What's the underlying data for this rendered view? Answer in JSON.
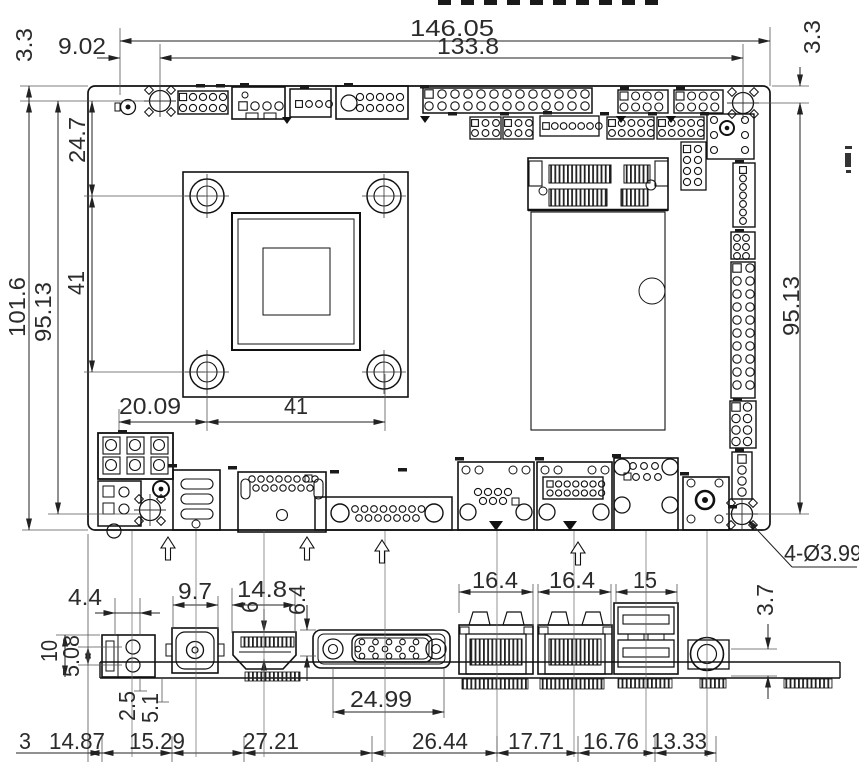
{
  "top_view": {
    "width_overall": "146.05",
    "width_holes": "133.8",
    "hole_offset_x": "9.02",
    "edge_top_left": "3.3",
    "edge_top_right": "3.3",
    "height_overall": "101.6",
    "height_holes_left": "95.13",
    "height_holes_right": "95.13",
    "cpu_hole_top": "24.7",
    "cpu_pitch_v": "41",
    "cpu_offset_x": "20.09",
    "cpu_pitch_h": "41",
    "mount_hole_note": "4-Ø3.99"
  },
  "rear_view": {
    "power_width": "4.4",
    "power_height": "10",
    "power_pin_pitch": "5.08",
    "dc_width": "9.7",
    "hdmi_width": "14.8",
    "hdmi_height": "6",
    "vga_height": "6.4",
    "vga_screw_span": "24.99",
    "lan1_width": "16.4",
    "lan2_width": "16.4",
    "usb_width": "15",
    "audio_height": "3.7",
    "pad_offset_1": "2.5",
    "pad_offset_2": "5.1",
    "chain": [
      "3",
      "14.87",
      "15.29",
      "27.21",
      "26.44",
      "17.71",
      "16.76",
      "13.33"
    ]
  }
}
